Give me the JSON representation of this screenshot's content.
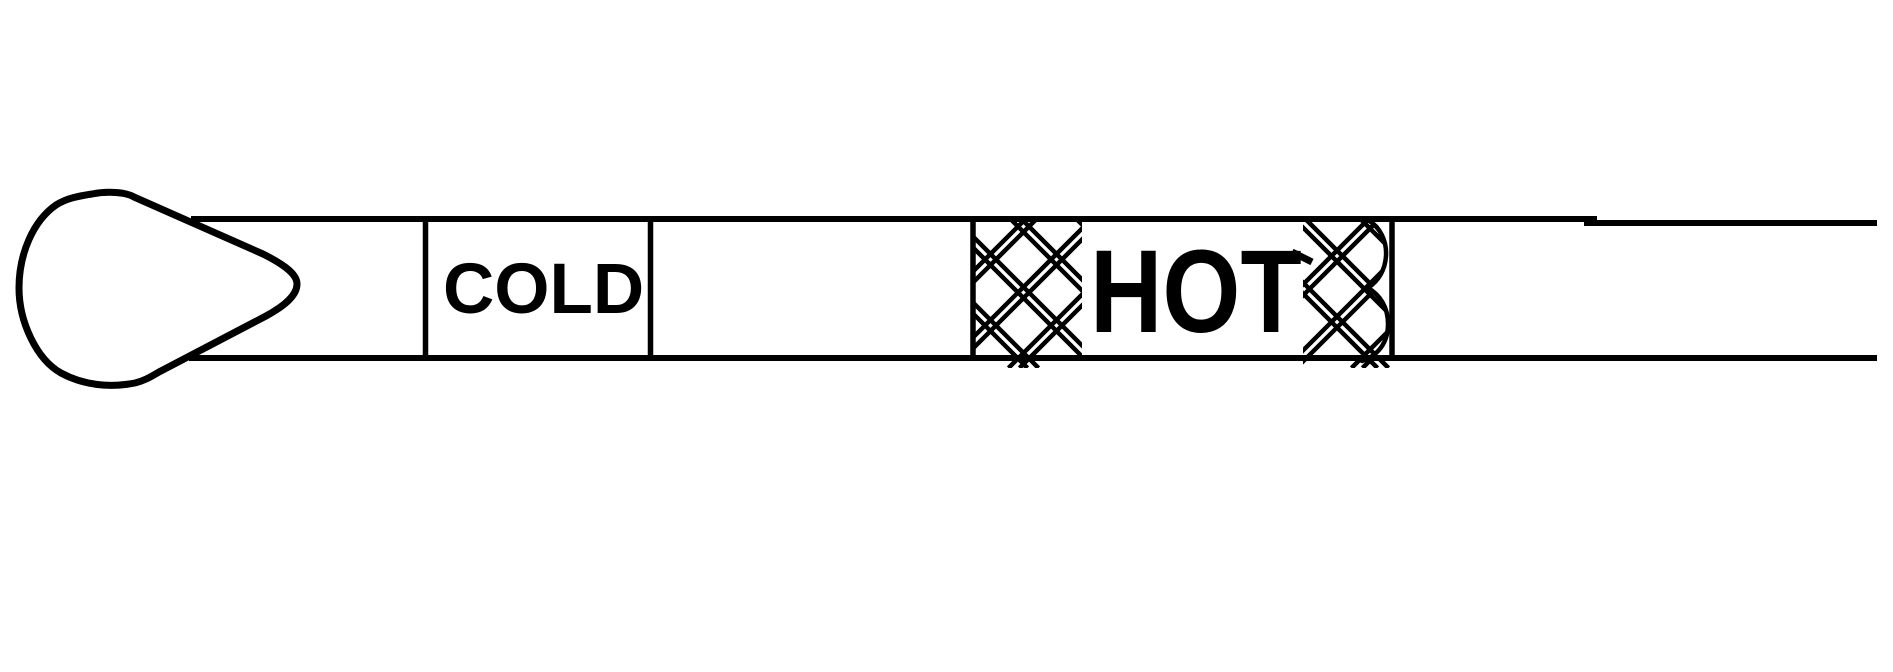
{
  "colors": {
    "ink": "#000000",
    "background": "#ffffff"
  },
  "dipstick": {
    "cold_label": "COLD",
    "hot_label": "HOT"
  }
}
